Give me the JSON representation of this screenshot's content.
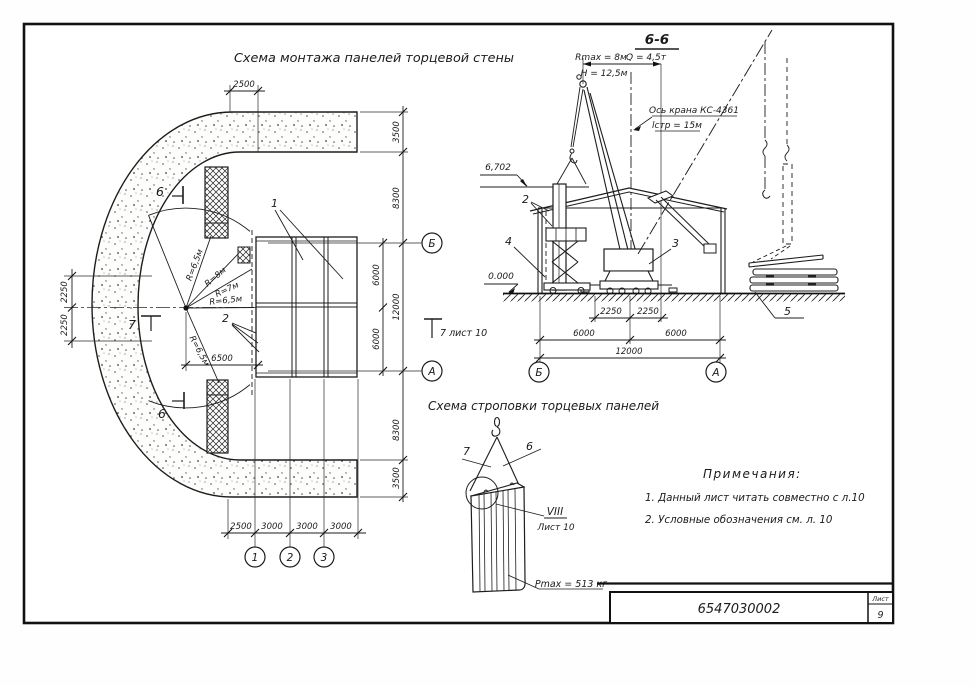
{
  "plan": {
    "title": "Схема монтажа панелей торцевой стены",
    "dim_top": "2500",
    "dim_left_top": "2250",
    "dim_left_bottom": "2250",
    "dim_right": [
      "3500",
      "8300",
      "6000",
      "12000",
      "6000",
      "8300",
      "3500"
    ],
    "dim_bottom": [
      "2500",
      "3000",
      "3000",
      "3000"
    ],
    "dim_opening": "6500",
    "radius_upper": "R=6,5м",
    "radius_8": "R=8м",
    "radius_7": "R=7м",
    "radius_mid": "R=6,5м",
    "radius_lower": "R=6,5м",
    "axis_b": "Б",
    "axis_a": "А",
    "axis_1": "1",
    "axis_2": "2",
    "axis_3": "3",
    "section_mark_top": "6",
    "section_mark_bottom": "6",
    "section_mark_7": "7",
    "callout_1": "1",
    "callout_2": "2",
    "ref_note": "7 лист 10"
  },
  "elevation": {
    "title": "6-6",
    "r_max": "Rmax = 8м",
    "capacity": "Q = 4,5т",
    "height": "Н = 12,5м",
    "axis_label": "Ось крана КС-4361",
    "boom_label": "lстр = 15м",
    "level_top": "6,702",
    "level_zero": "0.000",
    "dim_2250_l": "2250",
    "dim_2250_r": "2250",
    "dim_6000_l": "6000",
    "dim_6000_r": "6000",
    "dim_12000": "12000",
    "axis_b": "Б",
    "axis_a": "А",
    "callout_2": "2",
    "callout_3": "3",
    "callout_4": "4",
    "callout_5": "5"
  },
  "strop": {
    "title": "Схема строповки торцевых панелей",
    "callout_left": "7",
    "callout_right": "6",
    "detail_roman": "VIII",
    "detail_sheet": "Лист 10",
    "weight": "Pmax = 513 кг"
  },
  "notes": {
    "title": "Примечания:",
    "item_1": "1. Данный лист читать совместно с л.10",
    "item_2": "2. Условные обозначения см. л. 10"
  },
  "stamp": {
    "doc_number": "6547030002",
    "sheet_label": "Лист",
    "sheet_number": "9"
  }
}
